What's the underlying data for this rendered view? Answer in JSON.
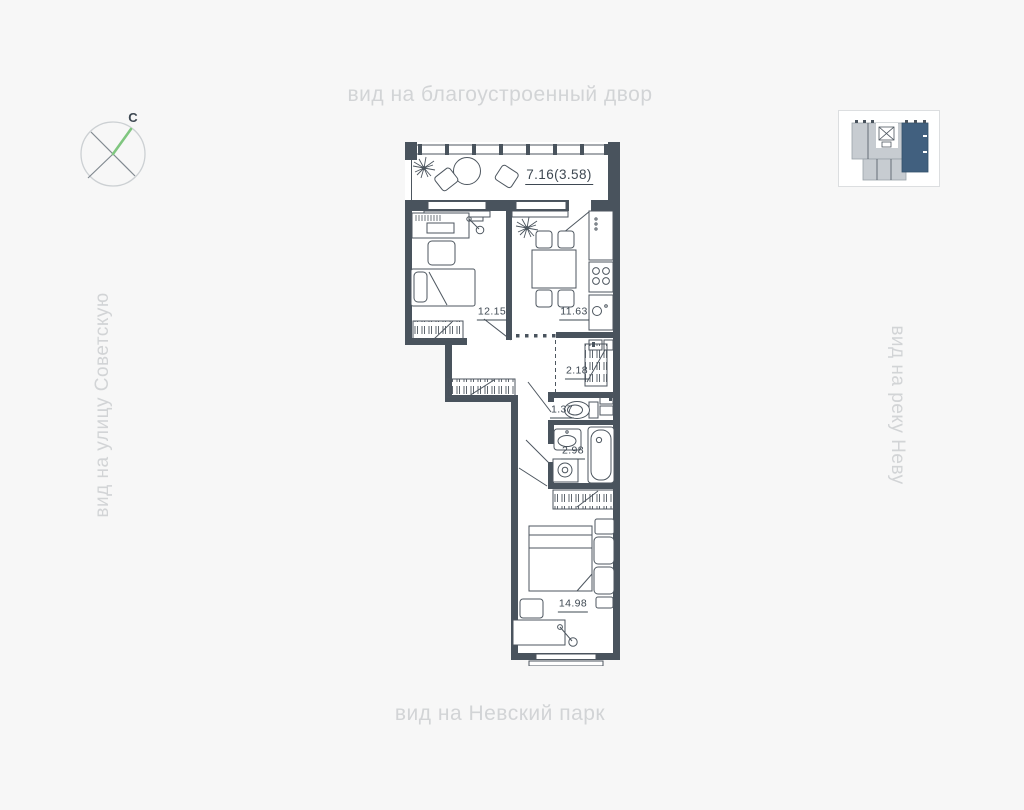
{
  "views": {
    "top": "вид на благоустроенный двор",
    "bottom": "вид на Невский парк",
    "left": "вид на улицу Советскую",
    "right": "вид на реку Неву"
  },
  "compass": {
    "north_label": "С"
  },
  "rooms": [
    {
      "name": "balcony",
      "area": "7.16(3.58)"
    },
    {
      "name": "bedroom-1",
      "area": "12.15"
    },
    {
      "name": "kitchen",
      "area": "11.63"
    },
    {
      "name": "wardrobe",
      "area": "2.18"
    },
    {
      "name": "wc",
      "area": "1.37"
    },
    {
      "name": "bathroom",
      "area": "2.98"
    },
    {
      "name": "bedroom-2",
      "area": "14.98"
    }
  ],
  "colors": {
    "wall": "#49535d",
    "furniture_line": "#4d565f",
    "compass_green": "#7fc67f",
    "thumbnail_highlight": "#41607f",
    "muted_text": "#d2d4d6",
    "label_text": "#3e4852",
    "background": "#f7f7f7"
  }
}
